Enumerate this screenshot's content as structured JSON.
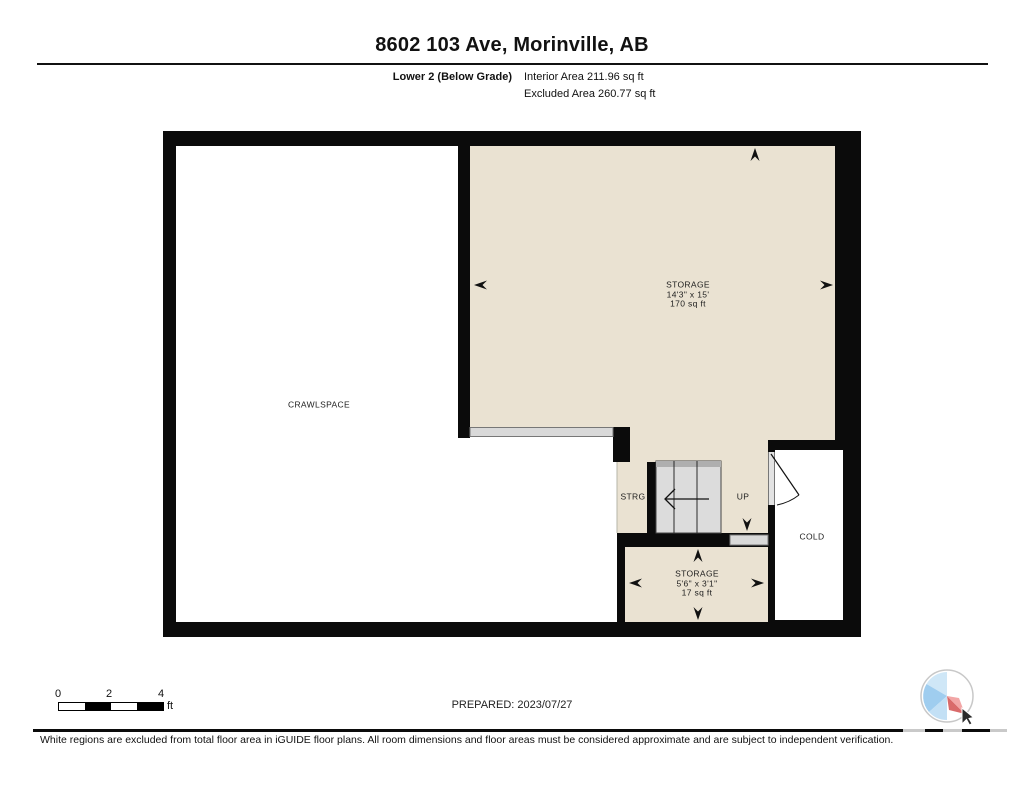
{
  "header": {
    "title": "8602 103 Ave, Morinville, AB",
    "floor_label": "Lower 2 (Below Grade)",
    "interior_area": "Interior Area 211.96 sq ft",
    "excluded_area": "Excluded Area 260.77 sq ft"
  },
  "plan": {
    "rooms": {
      "crawlspace": {
        "name": "CRAWLSPACE"
      },
      "storage_main": {
        "name": "STORAGE",
        "dims": "14'3\" x 15'",
        "area": "170 sq ft"
      },
      "storage_small": {
        "name": "STORAGE",
        "dims": "5'6\" x 3'1\"",
        "area": "17 sq ft"
      },
      "strg": {
        "name": "STRG"
      },
      "stairs_up": {
        "name": "UP"
      },
      "cold": {
        "name": "COLD"
      }
    },
    "colors": {
      "room_fill": "#EAE2D2",
      "wall": "#0B0B0B",
      "opening_gray": "#D9D9D9",
      "stair_tread": "#DCDCDC",
      "logo_blue": "#9FCDEF",
      "logo_red": "#D96A6A"
    }
  },
  "scalebar": {
    "ticks": [
      "0",
      "2",
      "4"
    ],
    "unit": "ft"
  },
  "footer": {
    "prepared": "PREPARED: 2023/07/27",
    "disclaimer": "White regions are excluded from total floor area in iGUIDE floor plans. All room dimensions and floor areas must be considered approximate and are subject to independent verification."
  }
}
